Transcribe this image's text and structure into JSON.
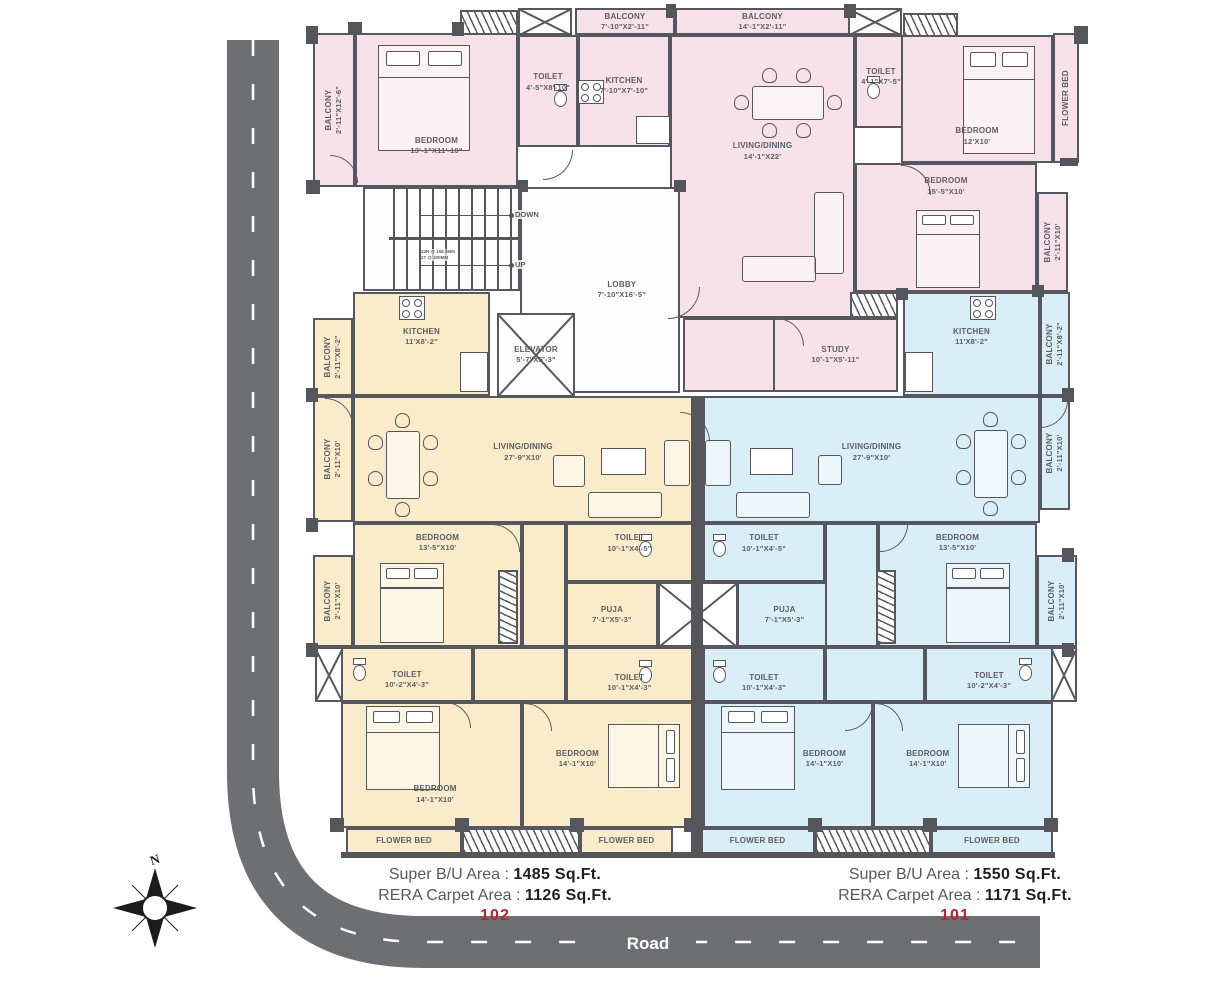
{
  "road": {
    "label": "Road"
  },
  "compass": {
    "label": "N"
  },
  "units": [
    {
      "number": "102",
      "super_label": "Super B/U Area :",
      "super_value": "1485 Sq.Ft.",
      "rera_label": "RERA Carpet Area :",
      "rera_value": "1126 Sq.Ft."
    },
    {
      "number": "101",
      "super_label": "Super B/U Area :",
      "super_value": "1550 Sq.Ft.",
      "rera_label": "RERA Carpet Area :",
      "rera_value": "1171 Sq.Ft."
    }
  ],
  "colors": {
    "pink": "#f8e2ea",
    "cream": "#faecca",
    "blue": "#daeef7",
    "wall": "#57585f",
    "road": "#6e6f72",
    "unit_number_red": "#c4202e",
    "label_gray": "#5c5d63"
  },
  "plan": {
    "stairs": {
      "down": "DOWN",
      "up": "UP",
      "note1": "22R @ 158.3MM",
      "note2": "2T @ 300MM"
    },
    "rooms": [
      {
        "name": "BALCONY",
        "dims": "2'-11\"X12'-6\"",
        "x": 313,
        "y": 33,
        "w": 42,
        "h": 154,
        "c": "pink",
        "v": 1
      },
      {
        "name": "BEDROOM",
        "dims": "13'-1\"X11'-10\"",
        "x": 355,
        "y": 33,
        "w": 163,
        "h": 154,
        "c": "pink",
        "ly": 0.74
      },
      {
        "name": "TOILET",
        "dims": "4'-5\"X8'-10\"",
        "x": 518,
        "y": 35,
        "w": 60,
        "h": 112,
        "c": "pink",
        "ly": 0.42
      },
      {
        "name": "KITCHEN",
        "dims": "7'-10\"X7'-10\"",
        "x": 578,
        "y": 35,
        "w": 92,
        "h": 112,
        "c": "pink",
        "ly": 0.45
      },
      {
        "name": "BALCONY",
        "dims": "7'-10\"X2'-11\"",
        "x": 575,
        "y": 8,
        "w": 100,
        "h": 27,
        "c": "pink"
      },
      {
        "name": "BALCONY",
        "dims": "14'-1\"X2'-11\"",
        "x": 675,
        "y": 8,
        "w": 175,
        "h": 27,
        "c": "pink"
      },
      {
        "name": "LIVING/DINING",
        "dims": "14'-1\"X22'",
        "x": 670,
        "y": 35,
        "w": 185,
        "h": 283,
        "c": "pink",
        "ly": 0.41
      },
      {
        "name": "TOILET",
        "dims": "4'-1\"X7'-5\"",
        "x": 855,
        "y": 35,
        "w": 52,
        "h": 93,
        "c": "pink",
        "ly": 0.45
      },
      {
        "name": "BEDROOM",
        "dims": "12'X10'",
        "x": 901,
        "y": 35,
        "w": 152,
        "h": 128,
        "c": "pink",
        "ly": 0.8
      },
      {
        "name": "FLOWER BED",
        "dims": "",
        "x": 1053,
        "y": 33,
        "w": 26,
        "h": 130,
        "c": "pink",
        "v": 1
      },
      {
        "name": "BEDROOM",
        "dims": "15'-5\"X10'",
        "x": 855,
        "y": 163,
        "w": 182,
        "h": 129,
        "c": "pink",
        "ly": 0.17
      },
      {
        "name": "BALCONY",
        "dims": "2'-11\"X10'",
        "x": 1037,
        "y": 192,
        "w": 31,
        "h": 100,
        "c": "pink",
        "v": 1
      },
      {
        "name": "",
        "dims": "",
        "x": 683,
        "y": 318,
        "w": 92,
        "h": 74,
        "c": "pink"
      },
      {
        "name": "STUDY",
        "dims": "10'-1\"X5'-11\"",
        "x": 773,
        "y": 318,
        "w": 125,
        "h": 74,
        "c": "pink"
      },
      {
        "name": "LOBBY",
        "dims": "7'-10\"X16'-5\"",
        "x": 520,
        "y": 187,
        "w": 160,
        "h": 206,
        "c": "white",
        "lx": 0.64
      },
      {
        "name": "ELEVATOR",
        "dims": "5'-7\"X5'-3\"",
        "x": 497,
        "y": 313,
        "w": 78,
        "h": 84,
        "c": "white",
        "X": 1
      },
      {
        "name": "BALCONY",
        "dims": "2'-11\"X8'-2\"",
        "x": 313,
        "y": 318,
        "w": 40,
        "h": 78,
        "c": "cream",
        "v": 1
      },
      {
        "name": "KITCHEN",
        "dims": "11'X8'-2\"",
        "x": 353,
        "y": 292,
        "w": 137,
        "h": 104,
        "c": "cream",
        "ly": 0.43
      },
      {
        "name": "BALCONY",
        "dims": "2'-11\"X10'",
        "x": 313,
        "y": 396,
        "w": 40,
        "h": 126,
        "c": "cream",
        "v": 1
      },
      {
        "name": "LIVING/DINING",
        "dims": "27'-9\"X10'",
        "x": 353,
        "y": 396,
        "w": 340,
        "h": 127,
        "c": "cream",
        "ly": 0.44
      },
      {
        "name": "BEDROOM",
        "dims": "13'-5\"X10'",
        "x": 353,
        "y": 523,
        "w": 169,
        "h": 124,
        "c": "cream",
        "ly": 0.15
      },
      {
        "name": "",
        "dims": "",
        "x": 522,
        "y": 523,
        "w": 44,
        "h": 124,
        "c": "cream"
      },
      {
        "name": "BALCONY",
        "dims": "2'-11\"X10'",
        "x": 313,
        "y": 555,
        "w": 40,
        "h": 92,
        "c": "cream",
        "v": 1
      },
      {
        "name": "TOILET",
        "dims": "10'-1\"X4'-5\"",
        "x": 566,
        "y": 523,
        "w": 127,
        "h": 59,
        "c": "cream",
        "ly": 0.33
      },
      {
        "name": "PUJA",
        "dims": "7'-1\"X5'-3\"",
        "x": 566,
        "y": 582,
        "w": 92,
        "h": 65,
        "c": "cream"
      },
      {
        "name": "TOILET",
        "dims": "10'-1\"X4'-3\"",
        "x": 566,
        "y": 647,
        "w": 127,
        "h": 55,
        "c": "cream",
        "ly": 0.66
      },
      {
        "name": "",
        "dims": "",
        "x": 473,
        "y": 647,
        "w": 93,
        "h": 55,
        "c": "cream"
      },
      {
        "name": "TOILET",
        "dims": "10'-2\"X4'-3\"",
        "x": 341,
        "y": 647,
        "w": 132,
        "h": 55,
        "c": "cream",
        "ly": 0.6
      },
      {
        "name": "BEDROOM",
        "dims": "14'-1\"X10'",
        "x": 341,
        "y": 702,
        "w": 181,
        "h": 126,
        "c": "cream",
        "lx": 0.52,
        "ly": 0.74
      },
      {
        "name": "BEDROOM",
        "dims": "14'-1\"X10'",
        "x": 522,
        "y": 702,
        "w": 171,
        "h": 126,
        "c": "cream",
        "lx": 0.32,
        "ly": 0.45
      },
      {
        "name": "FLOWER BED",
        "dims": "",
        "x": 346,
        "y": 828,
        "w": 116,
        "h": 26,
        "c": "cream"
      },
      {
        "name": "FLOWER BED",
        "dims": "",
        "x": 580,
        "y": 828,
        "w": 93,
        "h": 26,
        "c": "cream"
      },
      {
        "name": "KITCHEN",
        "dims": "11'X8'-2\"",
        "x": 903,
        "y": 292,
        "w": 137,
        "h": 104,
        "c": "blue",
        "ly": 0.43
      },
      {
        "name": "BALCONY",
        "dims": "2'-11\"X8'-2\"",
        "x": 1040,
        "y": 292,
        "w": 30,
        "h": 104,
        "c": "blue",
        "v": 1
      },
      {
        "name": "LIVING/DINING",
        "dims": "27'-9\"X10'",
        "x": 703,
        "y": 396,
        "w": 337,
        "h": 127,
        "c": "blue",
        "ly": 0.44
      },
      {
        "name": "BALCONY",
        "dims": "2'-11\"X10'",
        "x": 1040,
        "y": 396,
        "w": 30,
        "h": 114,
        "c": "blue",
        "v": 1
      },
      {
        "name": "TOILET",
        "dims": "10'-1\"X4'-5\"",
        "x": 703,
        "y": 523,
        "w": 122,
        "h": 59,
        "c": "blue",
        "ly": 0.33
      },
      {
        "name": "PUJA",
        "dims": "7'-1\"X5'-3\"",
        "x": 737,
        "y": 582,
        "w": 95,
        "h": 65,
        "c": "blue"
      },
      {
        "name": "TOILET",
        "dims": "10'-1\"X4'-3\"",
        "x": 703,
        "y": 647,
        "w": 122,
        "h": 55,
        "c": "blue",
        "ly": 0.66
      },
      {
        "name": "",
        "dims": "",
        "x": 825,
        "y": 523,
        "w": 53,
        "h": 124,
        "c": "blue"
      },
      {
        "name": "",
        "dims": "",
        "x": 825,
        "y": 647,
        "w": 100,
        "h": 55,
        "c": "blue"
      },
      {
        "name": "BEDROOM",
        "dims": "13'-5\"X10'",
        "x": 878,
        "y": 523,
        "w": 159,
        "h": 124,
        "c": "blue",
        "ly": 0.15
      },
      {
        "name": "BALCONY",
        "dims": "2'-11\"X10'",
        "x": 1037,
        "y": 555,
        "w": 40,
        "h": 92,
        "c": "blue",
        "v": 1
      },
      {
        "name": "TOILET",
        "dims": "10'-2\"X4'-3\"",
        "x": 925,
        "y": 647,
        "w": 128,
        "h": 55,
        "c": "blue",
        "ly": 0.62
      },
      {
        "name": "BEDROOM",
        "dims": "14'-1\"X10'",
        "x": 703,
        "y": 702,
        "w": 170,
        "h": 126,
        "c": "blue",
        "lx": 0.72,
        "ly": 0.45
      },
      {
        "name": "BEDROOM",
        "dims": "14'-1\"X10'",
        "x": 873,
        "y": 702,
        "w": 180,
        "h": 126,
        "c": "blue",
        "lx": 0.3,
        "ly": 0.45
      },
      {
        "name": "FLOWER BED",
        "dims": "",
        "x": 700,
        "y": 828,
        "w": 115,
        "h": 26,
        "c": "blue"
      },
      {
        "name": "FLOWER BED",
        "dims": "",
        "x": 931,
        "y": 828,
        "w": 122,
        "h": 26,
        "c": "blue"
      }
    ],
    "shafts": [
      {
        "x": 518,
        "y": 8,
        "w": 54,
        "h": 27
      },
      {
        "x": 848,
        "y": 8,
        "w": 54,
        "h": 27
      },
      {
        "x": 315,
        "y": 647,
        "w": 28,
        "h": 55
      },
      {
        "x": 1051,
        "y": 647,
        "w": 26,
        "h": 55
      },
      {
        "x": 658,
        "y": 582,
        "w": 80,
        "h": 65
      }
    ],
    "hatches": [
      {
        "x": 460,
        "y": 10,
        "w": 58,
        "h": 25,
        "o": "h"
      },
      {
        "x": 903,
        "y": 13,
        "w": 55,
        "h": 24,
        "o": "h"
      },
      {
        "x": 850,
        "y": 292,
        "w": 48,
        "h": 26,
        "o": "h"
      },
      {
        "x": 498,
        "y": 570,
        "w": 20,
        "h": 74,
        "o": "v"
      },
      {
        "x": 876,
        "y": 570,
        "w": 20,
        "h": 74,
        "o": "v"
      },
      {
        "x": 462,
        "y": 828,
        "w": 118,
        "h": 26,
        "o": "h"
      },
      {
        "x": 815,
        "y": 828,
        "w": 116,
        "h": 26,
        "o": "h"
      }
    ],
    "pillars": [
      [
        691,
        396,
        12,
        458
      ],
      [
        341,
        852,
        714,
        6
      ],
      [
        306,
        26,
        12,
        18
      ],
      [
        348,
        22,
        14,
        12
      ],
      [
        452,
        22,
        12,
        14
      ],
      [
        666,
        4,
        10,
        14
      ],
      [
        844,
        4,
        12,
        14
      ],
      [
        1074,
        26,
        14,
        18
      ],
      [
        1060,
        158,
        18,
        8
      ],
      [
        306,
        180,
        14,
        14
      ],
      [
        306,
        388,
        12,
        14
      ],
      [
        306,
        518,
        12,
        14
      ],
      [
        306,
        643,
        12,
        14
      ],
      [
        330,
        818,
        14,
        14
      ],
      [
        455,
        818,
        14,
        14
      ],
      [
        570,
        818,
        14,
        14
      ],
      [
        684,
        818,
        18,
        14
      ],
      [
        808,
        818,
        14,
        14
      ],
      [
        923,
        818,
        14,
        14
      ],
      [
        1044,
        818,
        14,
        14
      ],
      [
        1062,
        388,
        12,
        14
      ],
      [
        1062,
        548,
        12,
        14
      ],
      [
        1062,
        643,
        12,
        14
      ],
      [
        1032,
        285,
        12,
        12
      ],
      [
        516,
        180,
        12,
        12
      ],
      [
        674,
        180,
        12,
        12
      ],
      [
        896,
        288,
        12,
        12
      ]
    ],
    "doors": [
      [
        330,
        155,
        28,
        0
      ],
      [
        543,
        150,
        30,
        90
      ],
      [
        901,
        165,
        30,
        0
      ],
      [
        668,
        287,
        32,
        90
      ],
      [
        776,
        318,
        28,
        0
      ],
      [
        325,
        398,
        28,
        0
      ],
      [
        1040,
        400,
        28,
        90
      ],
      [
        492,
        524,
        28,
        0
      ],
      [
        880,
        524,
        28,
        90
      ],
      [
        445,
        702,
        26,
        0
      ],
      [
        524,
        703,
        28,
        0
      ],
      [
        845,
        703,
        28,
        90
      ],
      [
        875,
        703,
        28,
        0
      ],
      [
        680,
        412,
        30,
        0
      ]
    ],
    "furniture": [
      {
        "t": "bed",
        "x": 378,
        "y": 45,
        "w": 92,
        "h": 106,
        "o": "v"
      },
      {
        "t": "bed",
        "x": 963,
        "y": 46,
        "w": 72,
        "h": 108,
        "o": "v"
      },
      {
        "t": "bed",
        "x": 916,
        "y": 210,
        "w": 64,
        "h": 78,
        "o": "v"
      },
      {
        "t": "bed",
        "x": 380,
        "y": 563,
        "w": 64,
        "h": 80,
        "o": "v"
      },
      {
        "t": "bed",
        "x": 366,
        "y": 706,
        "w": 74,
        "h": 84,
        "o": "v"
      },
      {
        "t": "bed",
        "x": 608,
        "y": 724,
        "w": 72,
        "h": 64,
        "o": "h"
      },
      {
        "t": "bed",
        "x": 946,
        "y": 563,
        "w": 64,
        "h": 80,
        "o": "v"
      },
      {
        "t": "bed",
        "x": 721,
        "y": 706,
        "w": 74,
        "h": 84,
        "o": "v"
      },
      {
        "t": "bed",
        "x": 958,
        "y": 724,
        "w": 72,
        "h": 64,
        "o": "h"
      },
      {
        "t": "din",
        "x": 734,
        "y": 68,
        "o": "h"
      },
      {
        "t": "din",
        "x": 368,
        "y": 413,
        "o": "v"
      },
      {
        "t": "din",
        "x": 956,
        "y": 412,
        "o": "v"
      },
      {
        "t": "sofa",
        "x": 814,
        "y": 192,
        "w": 30,
        "h": 82
      },
      {
        "t": "sofa",
        "x": 742,
        "y": 256,
        "w": 74,
        "h": 26
      },
      {
        "t": "sofa",
        "x": 553,
        "y": 455,
        "w": 32,
        "h": 32
      },
      {
        "t": "sofa",
        "x": 588,
        "y": 492,
        "w": 74,
        "h": 26
      },
      {
        "t": "sofa",
        "x": 664,
        "y": 440,
        "w": 26,
        "h": 46
      },
      {
        "t": "sofa",
        "x": 705,
        "y": 440,
        "w": 26,
        "h": 46
      },
      {
        "t": "sofa",
        "x": 736,
        "y": 492,
        "w": 74,
        "h": 26
      },
      {
        "t": "sofa",
        "x": 818,
        "y": 455,
        "w": 24,
        "h": 30
      },
      {
        "t": "rect",
        "x": 601,
        "y": 448,
        "w": 45,
        "h": 27
      },
      {
        "t": "rect",
        "x": 750,
        "y": 448,
        "w": 43,
        "h": 27
      },
      {
        "t": "rect",
        "x": 636,
        "y": 116,
        "w": 34,
        "h": 28
      },
      {
        "t": "rect",
        "x": 460,
        "y": 352,
        "w": 28,
        "h": 40
      },
      {
        "t": "rect",
        "x": 905,
        "y": 352,
        "w": 28,
        "h": 40
      },
      {
        "t": "stove",
        "x": 578,
        "y": 80
      },
      {
        "t": "stove",
        "x": 399,
        "y": 296
      },
      {
        "t": "stove",
        "x": 970,
        "y": 296
      },
      {
        "t": "wc",
        "x": 553,
        "y": 84
      },
      {
        "t": "wc",
        "x": 866,
        "y": 76
      },
      {
        "t": "wc",
        "x": 638,
        "y": 534
      },
      {
        "t": "wc",
        "x": 712,
        "y": 534
      },
      {
        "t": "wc",
        "x": 638,
        "y": 660
      },
      {
        "t": "wc",
        "x": 712,
        "y": 660
      },
      {
        "t": "wc",
        "x": 352,
        "y": 658
      },
      {
        "t": "wc",
        "x": 1018,
        "y": 658
      }
    ]
  }
}
